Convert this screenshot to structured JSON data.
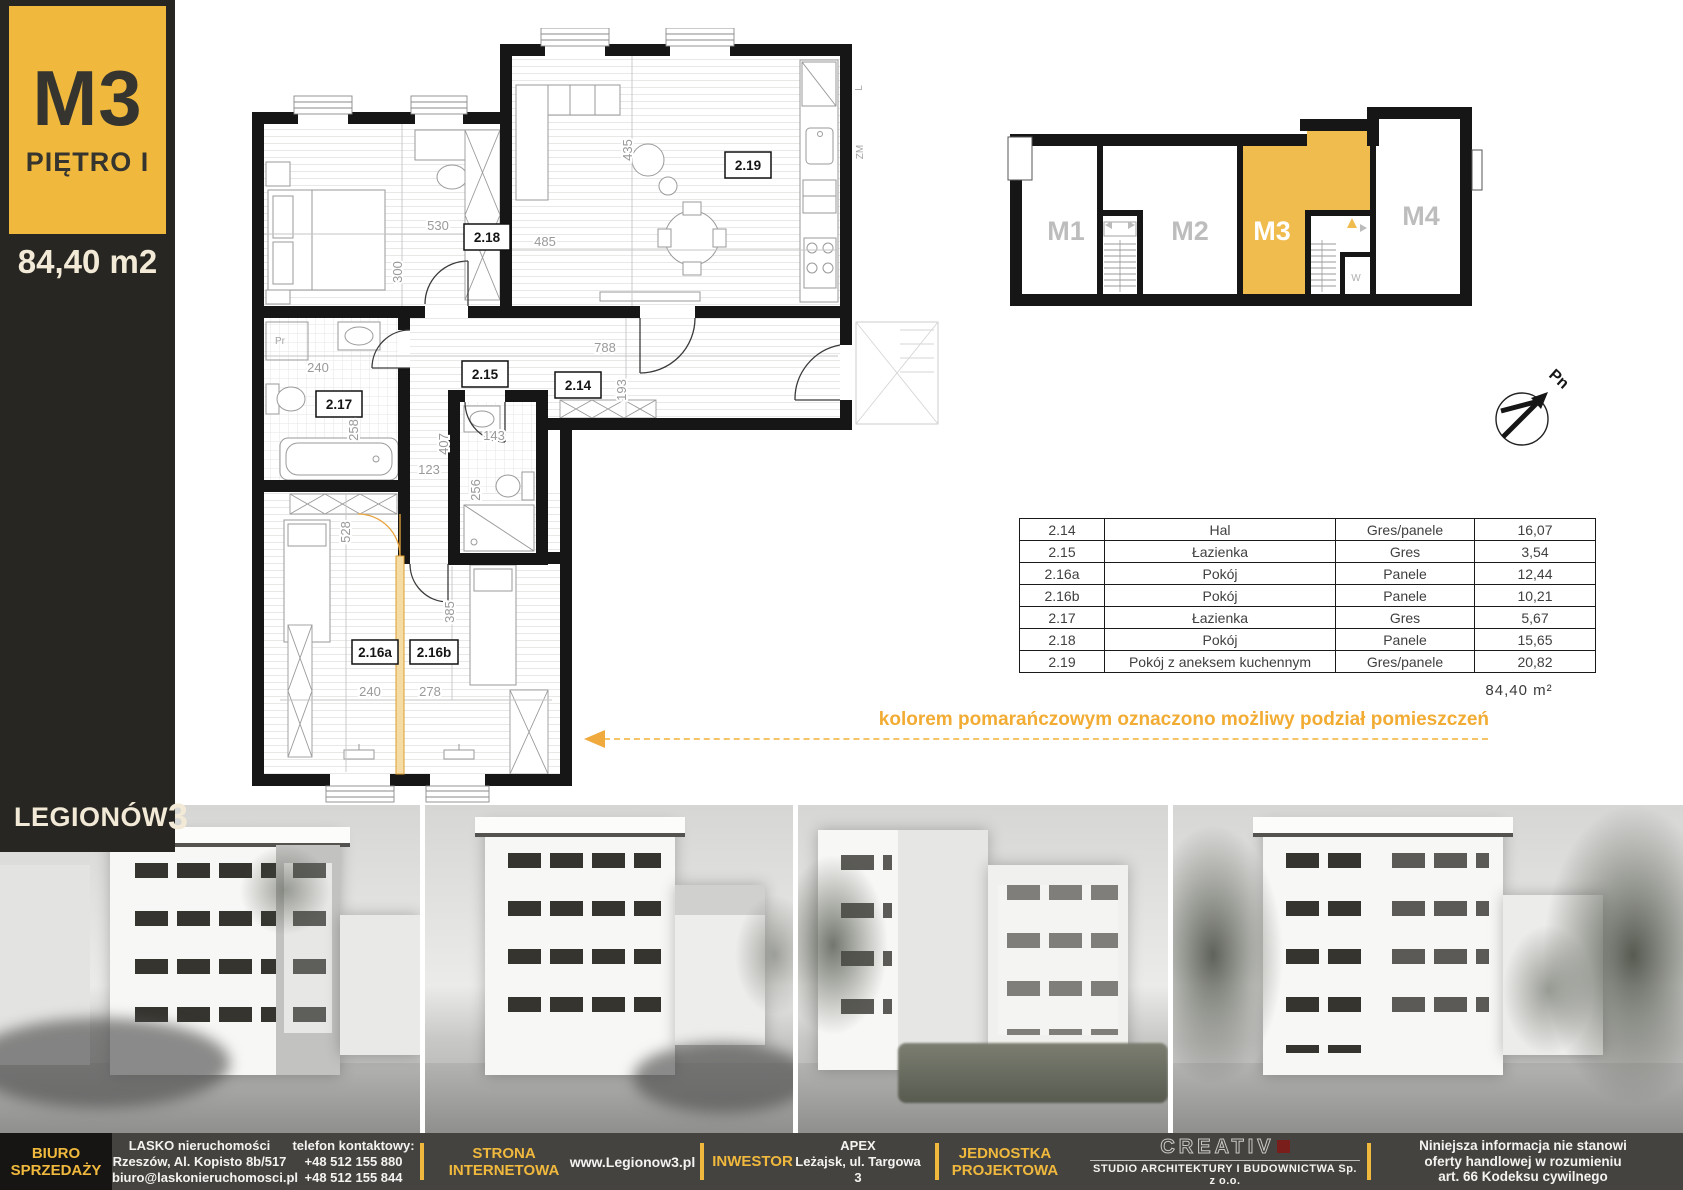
{
  "sidebar": {
    "unit": "M3",
    "floor": "PIĘTRO I",
    "area": "84,40 m2",
    "brand": "LEGIONÓW",
    "brand_number": "3"
  },
  "plan": {
    "rooms": {
      "r218": "2.18",
      "r219": "2.19",
      "r215": "2.15",
      "r214": "2.14",
      "r217": "2.17",
      "r216a": "2.16a",
      "r216b": "2.16b"
    },
    "dims": {
      "d530": "530",
      "d300": "300",
      "d485": "485",
      "d435": "435",
      "d788": "788",
      "d193": "193",
      "d240a": "240",
      "d258": "258",
      "d123": "123",
      "d407": "407",
      "d143": "143",
      "d256": "256",
      "d528": "528",
      "d385": "385",
      "d240b": "240",
      "d278": "278"
    },
    "annotations": {
      "pr": "Pr",
      "l": "L",
      "zm": "ZM"
    }
  },
  "overview": {
    "units": [
      {
        "label": "M1",
        "highlighted": false
      },
      {
        "label": "M2",
        "highlighted": false
      },
      {
        "label": "M3",
        "highlighted": true
      },
      {
        "label": "M4",
        "highlighted": false
      }
    ],
    "stair_room": "W",
    "compass": "Pn"
  },
  "table": {
    "rows": [
      {
        "no": "2.14",
        "name": "Hal",
        "finish": "Gres/panele",
        "area": "16,07"
      },
      {
        "no": "2.15",
        "name": "Łazienka",
        "finish": "Gres",
        "area": "3,54"
      },
      {
        "no": "2.16a",
        "name": "Pokój",
        "finish": "Panele",
        "area": "12,44"
      },
      {
        "no": "2.16b",
        "name": "Pokój",
        "finish": "Panele",
        "area": "10,21"
      },
      {
        "no": "2.17",
        "name": "Łazienka",
        "finish": "Gres",
        "area": "5,67"
      },
      {
        "no": "2.18",
        "name": "Pokój",
        "finish": "Panele",
        "area": "15,65"
      },
      {
        "no": "2.19",
        "name": "Pokój z aneksem kuchennym",
        "finish": "Gres/panele",
        "area": "20,82"
      }
    ],
    "total": "84,40  m²"
  },
  "note": "kolorem pomarańczowym oznaczono możliwy podział pomieszczeń",
  "footer": {
    "office": [
      "BIURO",
      "SPRZEDAŻY"
    ],
    "agency": [
      "LASKO nieruchomości",
      "Rzeszów, Al. Kopisto 8b/517",
      "biuro@laskonieruchomosci.pl"
    ],
    "phone": [
      "telefon kontaktowy:",
      "+48 512 155 880",
      "+48 512 155 844"
    ],
    "website_label": [
      "STRONA",
      "INTERNETOWA"
    ],
    "website": "www.Legionow3.pl",
    "investor_label": "INWESTOR",
    "investor": [
      "APEX",
      "Leżajsk, ul. Targowa 3"
    ],
    "design_label": [
      "JEDNOSTKA",
      "PROJEKTOWA"
    ],
    "studio_name": "CREATIV",
    "studio_sub": "STUDIO  ARCHITEKTURY I BUDOWNICTWA Sp. z o.o.",
    "disclaimer": [
      "Niniejsza informacja nie stanowi",
      "oferty handlowej w rozumieniu",
      "art. 66 Kodeksu cywilnego"
    ]
  },
  "colors": {
    "accent": "#F0B93D",
    "plan_highlight": "#F0BC4E",
    "note_orange": "#F2AC33"
  }
}
